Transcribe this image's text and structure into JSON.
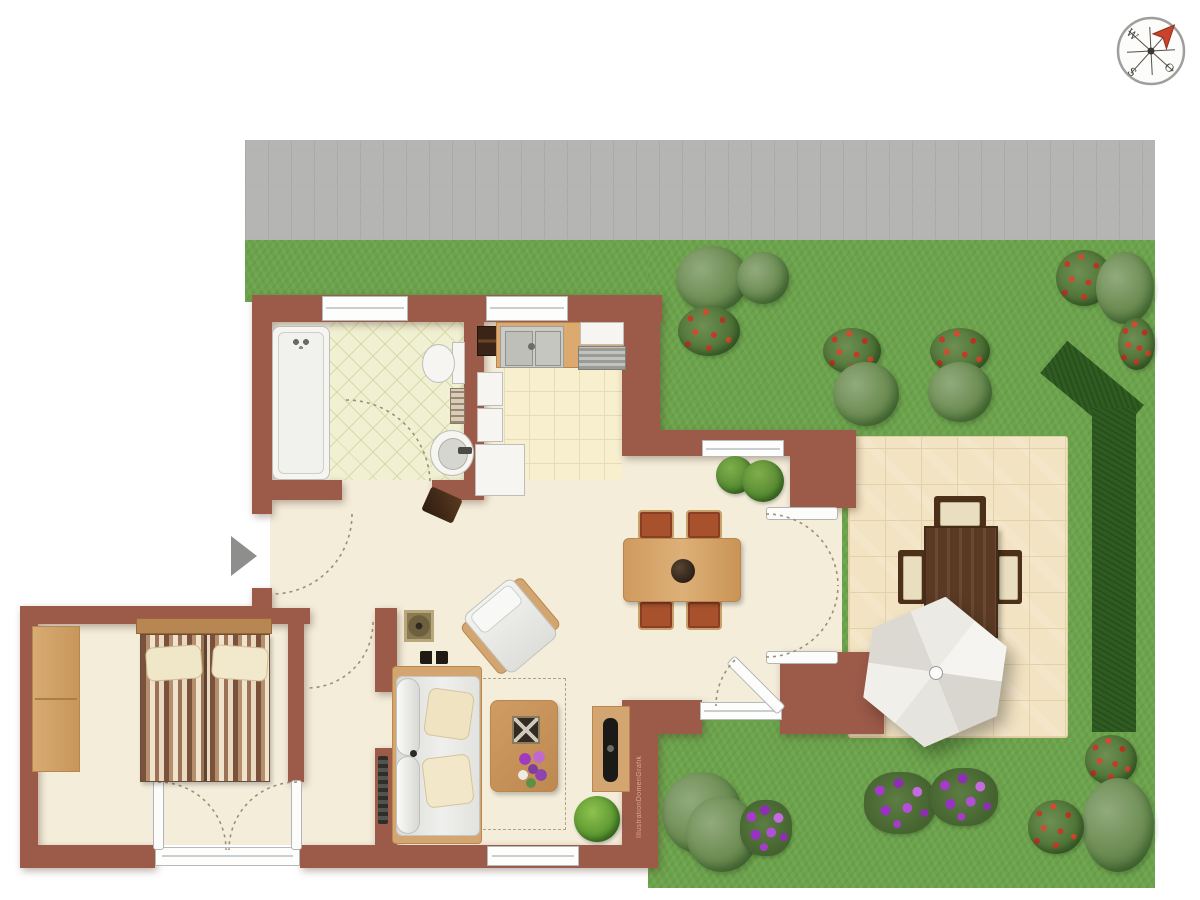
{
  "scene": {
    "kind": "apartment floor plan with garden, top view illustration"
  },
  "compass": {
    "letter_west": "W",
    "letter_east": "O",
    "letter_south": "S"
  },
  "watermark": {
    "text": "IllustrationDomenGrafik"
  },
  "palette": {
    "wall_brick": "#9c5a49",
    "lawn_green": "#6ba24b",
    "hedge_green": "#2f5c21",
    "pavement_gray": "#b5b5b3",
    "interior_floor": "#f4edda",
    "bathroom_tile": "#f0f0d2",
    "kitchen_tile": "#f7efce",
    "terrace_stone": "#f2e3c2",
    "furniture_wood": "#d3a671",
    "patio_wood": "#5a3a24",
    "dining_chair_rust": "#a8512d",
    "sofa_gray": "#e9e9e7",
    "parasol_gray": "#e7e5df",
    "flower_purple": "#a63bc9",
    "flower_red": "#c8432c",
    "compass_needle": "#c8432c",
    "entry_marker_gray": "#8e8e8c"
  }
}
